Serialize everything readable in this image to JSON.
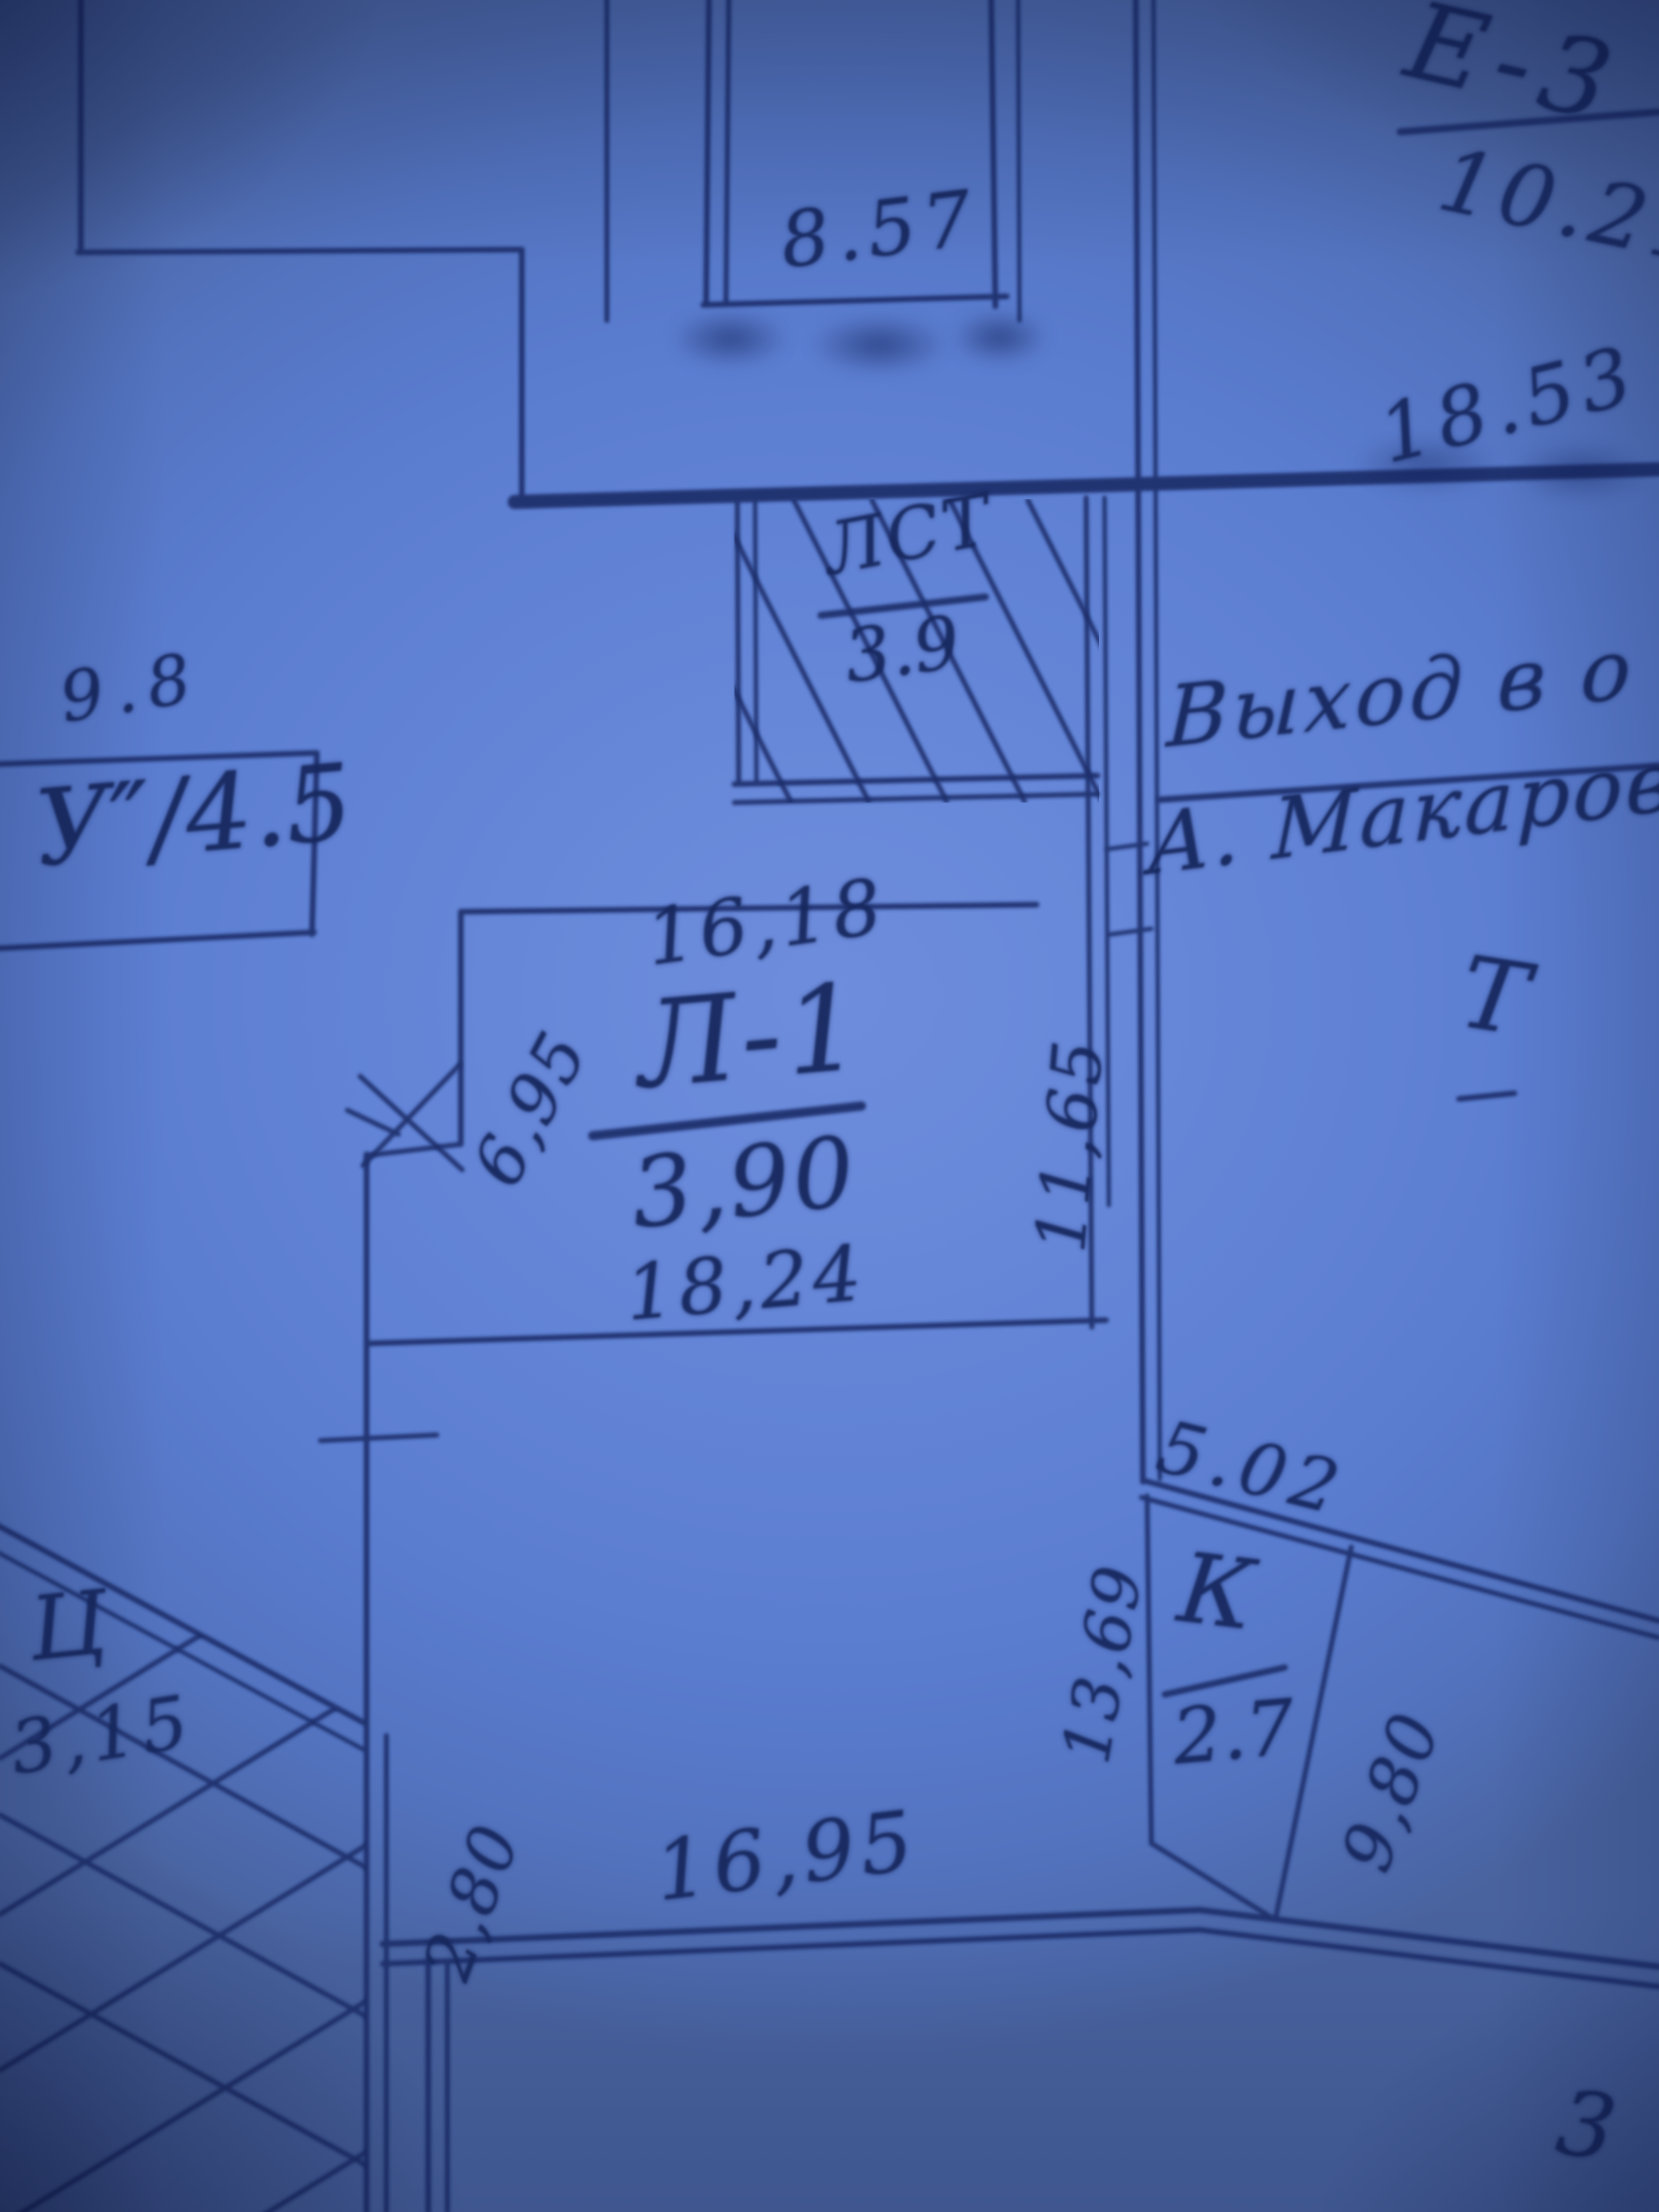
{
  "document": {
    "kind": "hand-drawn blueprint floor plan (photographed blueprint copy)",
    "paper_color": "#5b7bce",
    "ink_color": "#1c2e6b"
  },
  "labels": {
    "room_e3": "Е-3",
    "area_e3": "10.21",
    "dim_18_53": "18.53",
    "dim_8_57": "8.57",
    "room_lst": "ЛСТ",
    "area_lst": "3.9",
    "note_line1": "Выход в о",
    "note_line2": "А. Макарова",
    "mark_t": "Т",
    "dim_9_8": "9.8",
    "room_u": "У″/4.5",
    "dim_16_18": "16,18",
    "room_l1": "Л-1",
    "area_l1": "3,90",
    "dim_18_24": "18,24",
    "dim_11_65": "11,65",
    "dim_6_95": "6,95",
    "dim_5_02": "5.02",
    "room_k": "К",
    "area_k": "2.7",
    "dim_9_80": "9,80",
    "dim_13_69": "13,69",
    "zone_ts": "Ц",
    "dim_3_15": "3,15",
    "dim_16_95": "16,95",
    "dim_2_80": "2,80",
    "dim_corner_3": "3"
  }
}
